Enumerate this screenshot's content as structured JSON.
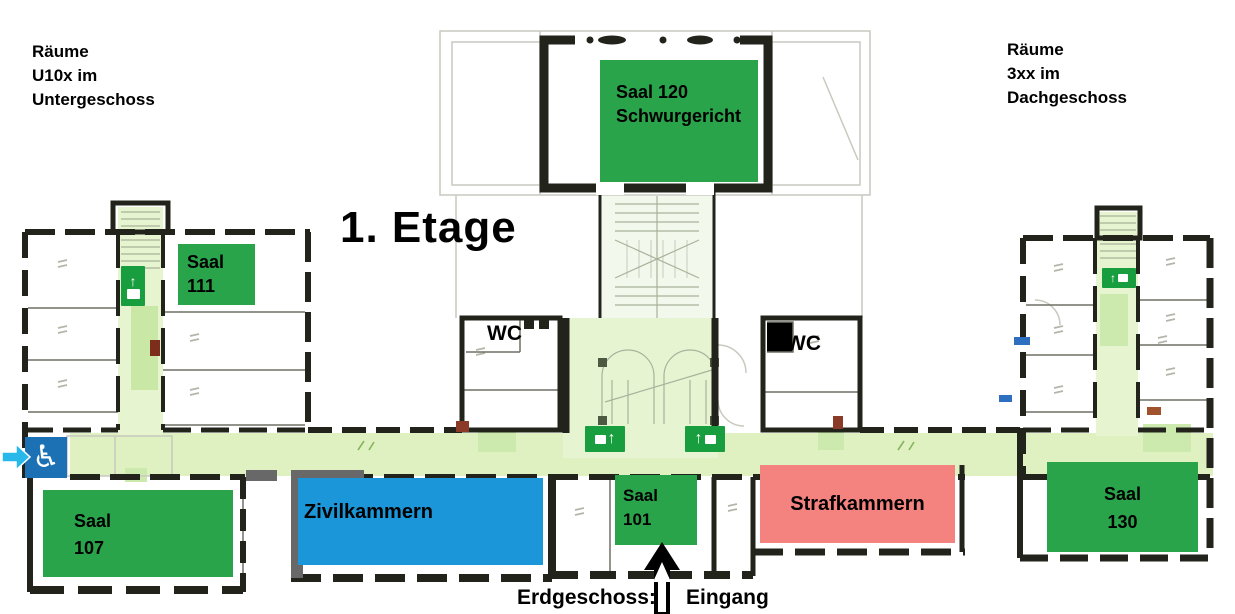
{
  "title": "1. Etage",
  "notes": {
    "basement": "Räume\nU10x im\nUntergeschoss",
    "attic": "Räume\n3xx im\nDachgeschoss"
  },
  "rooms": [
    {
      "id": "saal-120",
      "label": "Saal 120\nSchwurgericht",
      "color": "#2aa44b"
    },
    {
      "id": "saal-111",
      "label": "Saal\n111",
      "color": "#2aa44b"
    },
    {
      "id": "saal-107",
      "label": "Saal\n107",
      "color": "#2aa44b"
    },
    {
      "id": "zivilkammern",
      "label": "Zivilkammern",
      "color": "#1b96d8"
    },
    {
      "id": "saal-101",
      "label": "Saal\n101",
      "color": "#2aa44b"
    },
    {
      "id": "strafkammern",
      "label": "Strafkammern",
      "color": "#f4827f"
    },
    {
      "id": "saal-130",
      "label": "Saal\n130",
      "color": "#2aa44b"
    }
  ],
  "facilities": {
    "wc_left": "WC",
    "wc_right": "WC"
  },
  "legend": {
    "ground_floor": "Erdgeschoss:",
    "entrance": "Eingang"
  },
  "icons": {
    "up_arrow": "↑",
    "wheelchair": "♿"
  },
  "colors": {
    "room_green": "#2aa44b",
    "room_blue": "#1b96d8",
    "room_pink": "#f4827f",
    "corridor_green": "#dff1c1",
    "exit_sign_green": "#189e3f",
    "accessible_blue": "#1c70b4",
    "entrance_arrow_cyan": "#29b8ea",
    "wall_black": "#22241c",
    "annotation_gray": "#686868"
  }
}
